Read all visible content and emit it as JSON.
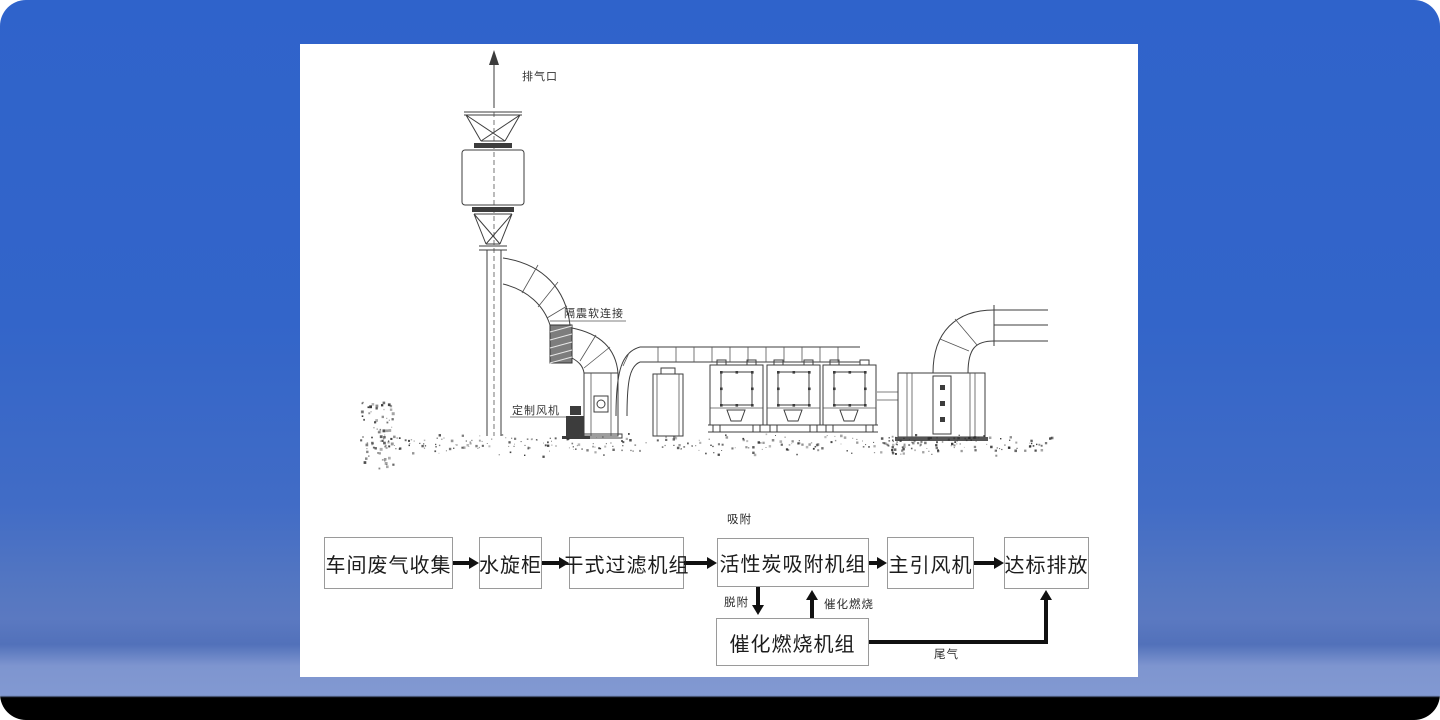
{
  "background": {
    "top_color": "#2f63cb",
    "bottom_strip_color": "#000000",
    "panel_color": "#ffffff"
  },
  "diagram": {
    "labels": {
      "exhaust_outlet": "排气口",
      "shock_absorbing_flexible_joint": "隔震软连接",
      "custom_fan": "定制风机"
    }
  },
  "flowchart": {
    "boxes": [
      {
        "label": "车间废气收集"
      },
      {
        "label": "水旋柜"
      },
      {
        "label": "干式过滤机组"
      },
      {
        "label": "活性炭吸附机组"
      },
      {
        "label": "主引风机"
      },
      {
        "label": "达标排放"
      },
      {
        "label": "催化燃烧机组"
      }
    ],
    "annotations": {
      "adsorption": "吸附",
      "desorption": "脱附",
      "catalytic_combustion": "催化燃烧",
      "tail_gas": "尾气"
    }
  }
}
